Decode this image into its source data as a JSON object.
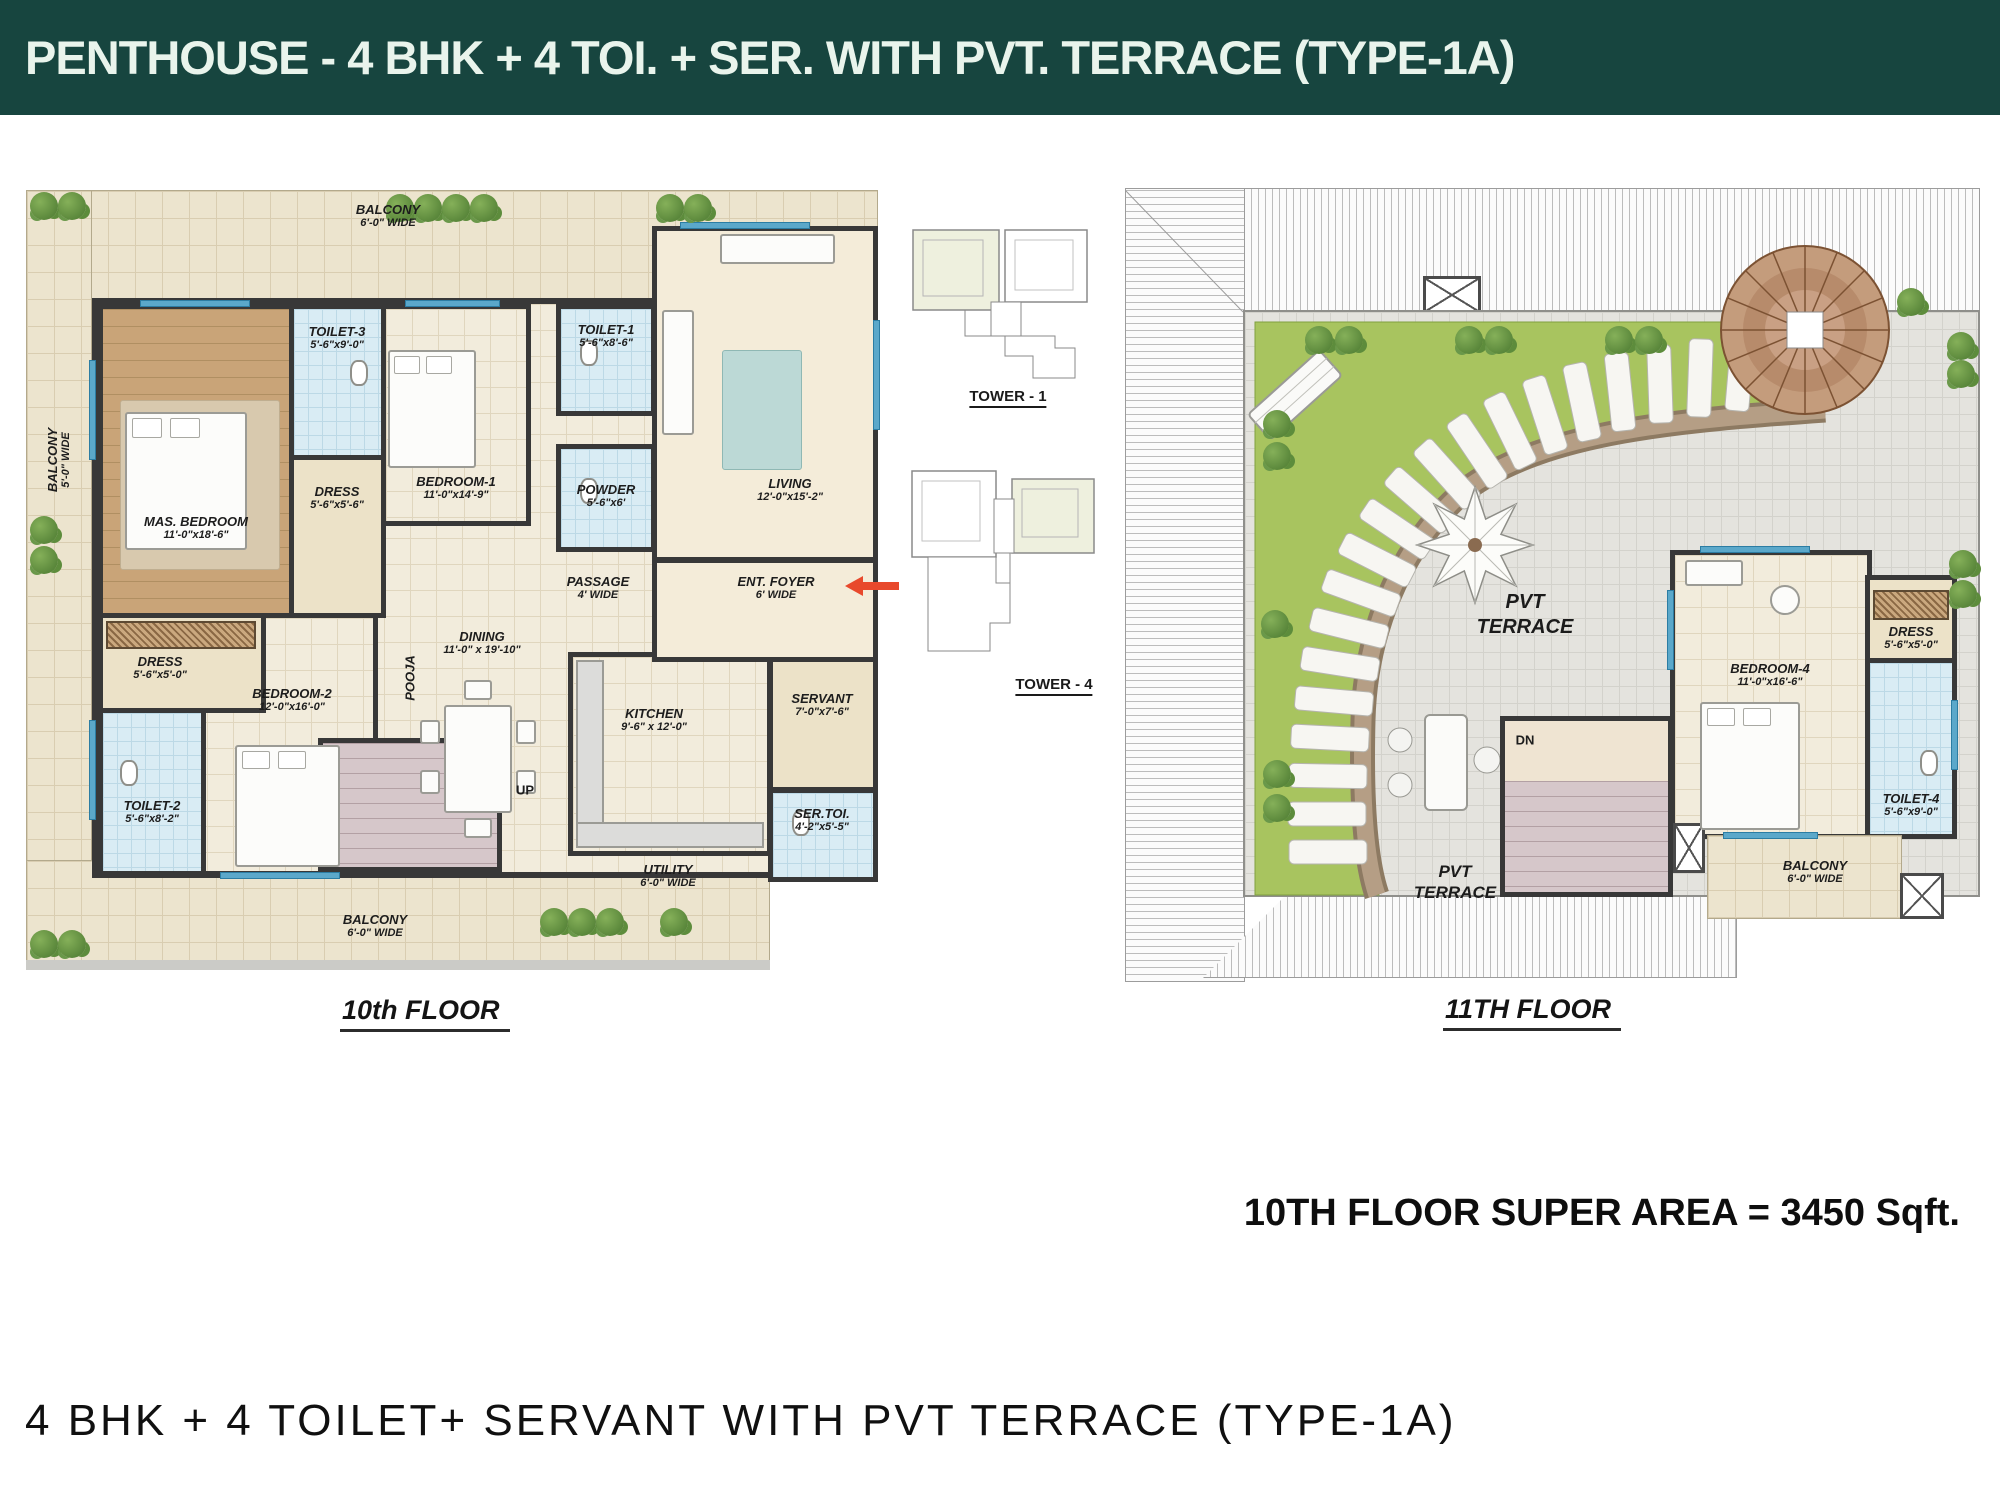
{
  "header": {
    "title": "PENTHOUSE - 4 BHK + 4 TOI. + SER. WITH PVT. TERRACE (TYPE-1A)"
  },
  "plan10": {
    "caption": "10th FLOOR",
    "balconies": {
      "top": {
        "name": "BALCONY",
        "dim": "6'-0\" WIDE"
      },
      "left": {
        "name": "BALCONY",
        "dim": "5'-0\" WIDE"
      },
      "bottom": {
        "name": "BALCONY",
        "dim": "6'-0\" WIDE"
      },
      "utility": {
        "name": "UTILITY",
        "dim": "6'-0\" WIDE"
      }
    },
    "rooms": {
      "mas_bedroom": {
        "name": "MAS. BEDROOM",
        "dim": "11'-0\"x18'-6\""
      },
      "toilet3": {
        "name": "TOILET-3",
        "dim": "5'-6\"x9'-0\""
      },
      "dress_mas": {
        "name": "DRESS",
        "dim": "5'-6\"x5'-6\""
      },
      "bedroom1": {
        "name": "BEDROOM-1",
        "dim": "11'-0\"x14'-9\""
      },
      "toilet1": {
        "name": "TOILET-1",
        "dim": "5'-6\"x8'-6\""
      },
      "powder": {
        "name": "POWDER",
        "dim": "5'-6\"x6'"
      },
      "living": {
        "name": "LIVING",
        "dim": "12'-0\"x15'-2\""
      },
      "passage": {
        "name": "PASSAGE",
        "dim": "4' WIDE"
      },
      "ent_foyer": {
        "name": "ENT. FOYER",
        "dim": "6' WIDE"
      },
      "pooja": {
        "name": "POOJA"
      },
      "dining": {
        "name": "DINING",
        "dim": "11'-0\" x 19'-10\""
      },
      "kitchen": {
        "name": "KITCHEN",
        "dim": "9'-6\" x 12'-0\""
      },
      "dress2": {
        "name": "DRESS",
        "dim": "5'-6\"x5'-0\""
      },
      "bedroom2": {
        "name": "BEDROOM-2",
        "dim": "12'-0\"x16'-0\""
      },
      "toilet2": {
        "name": "TOILET-2",
        "dim": "5'-6\"x8'-2\""
      },
      "servant": {
        "name": "SERVANT",
        "dim": "7'-0\"x7'-6\""
      },
      "ser_toi": {
        "name": "SER.TOI.",
        "dim": "4'-2\"x5'-5\""
      },
      "up_label": "UP"
    }
  },
  "towers": {
    "tower1_label": "TOWER - 1",
    "tower4_label": "TOWER - 4"
  },
  "plan11": {
    "caption": "11TH FLOOR",
    "terrace_label": {
      "line1": "PVT",
      "line2": "TERRACE"
    },
    "terrace_label2": {
      "line1": "PVT",
      "line2": "TERRACE"
    },
    "dn_label": "DN",
    "rooms": {
      "bedroom4": {
        "name": "BEDROOM-4",
        "dim": "11'-0\"x16'-6\""
      },
      "dress4": {
        "name": "DRESS",
        "dim": "5'-6\"x5'-0\""
      },
      "toilet4": {
        "name": "TOILET-4",
        "dim": "5'-6\"x9'-0\""
      },
      "balcony": {
        "name": "BALCONY",
        "dim": "6'-0\" WIDE"
      }
    }
  },
  "footer": {
    "super_area": "10TH FLOOR SUPER AREA = 3450 Sqft.",
    "subtitle": "4 BHK + 4 TOILET+ SERVANT WITH PVT TERRACE (TYPE-1A)"
  },
  "colors": {
    "header_bg": "#17453f",
    "header_text": "#e9f4ec",
    "wall": "#383838",
    "tile_cream": "#ece4ce",
    "tile_blue": "#d9ecf4",
    "wood": "#c9a478",
    "lawn": "#a8c45f",
    "path_brown": "#b59e85",
    "stairs": "#d6c7ca",
    "window_blue": "#5ba8ca",
    "arrow_red": "#e8492c"
  }
}
